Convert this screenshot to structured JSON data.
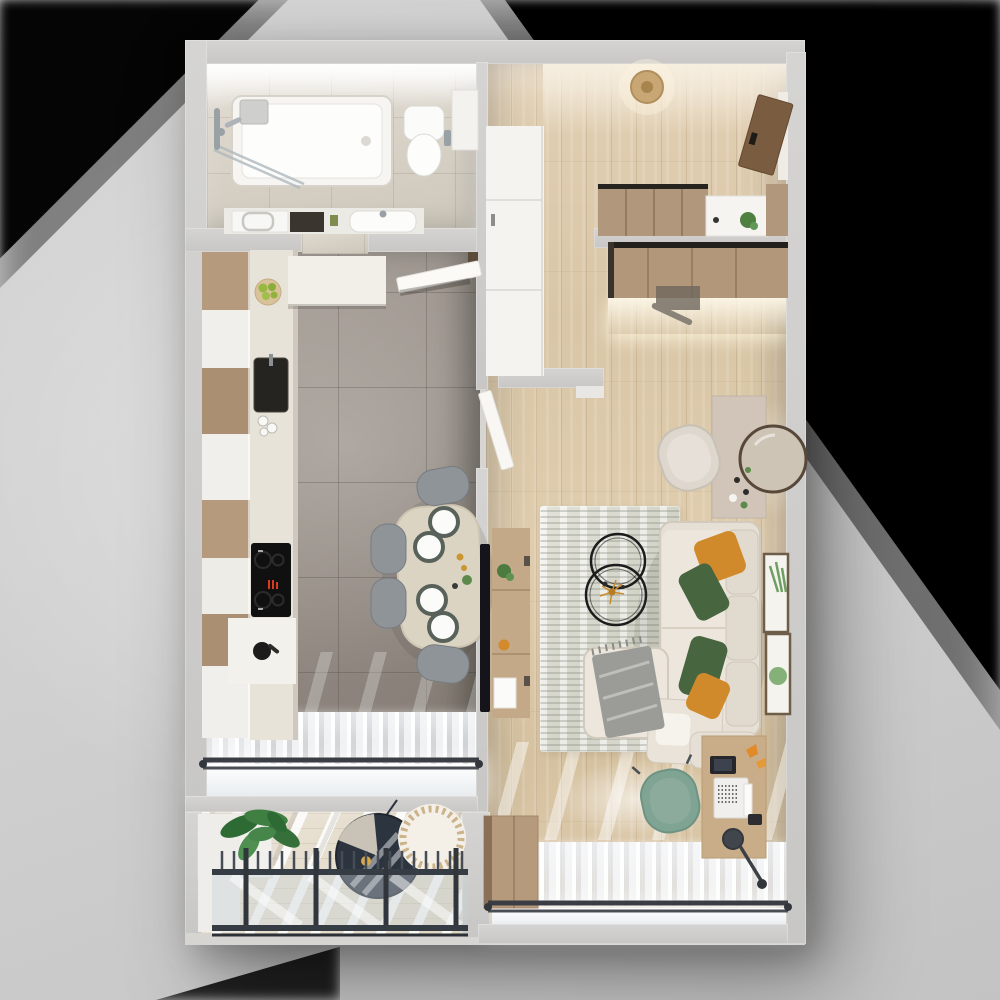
{
  "scene": {
    "description": "Top-down 3D architectural render of a one-bedroom apartment floor plan",
    "view": "top-down cutaway",
    "background": "grey studio backdrop with hard black corner shadows top-left and top-right"
  },
  "palette": {
    "bg": "#d6d6d6",
    "shadow": "#060606",
    "wall": "#d5d4d2",
    "bathFloor": "#e3ddd3",
    "kitchenTile": "#a49c94",
    "woodFloor": "#d9c6a6",
    "deck": "#ded5c2",
    "rug": "#d3d4c8",
    "counter": "#e8e3d8",
    "cabinetWood": "#b69a7e",
    "cabinetWhite": "#f1efeb",
    "sofa": "#e5dfd5",
    "pillowOrange": "#d18a2b",
    "pillowGreen": "#47653f",
    "throwGrey": "#9b9b97",
    "railing": "#363c44",
    "glassTint": "#e9edf0",
    "chairGrey": "#8f9499",
    "officeChairTeal": "#80a494",
    "doorBrown": "#7a5c40",
    "plantGreen": "#4c7a3f",
    "brass": "#c9962f",
    "displayRed": "#d93a20",
    "tvBlack": "#14141a",
    "mirrorFrame": "#57483a",
    "curtain": "#f2f3f5"
  },
  "rooms": {
    "bathroom": {
      "name": "Bathroom",
      "items": [
        "bathtub",
        "shower-glass-screen",
        "shower-set",
        "rain-shower-head",
        "toilet",
        "toilet-paper-holder",
        "storage-shelf",
        "vanity-counter",
        "washing-machine",
        "dark-cabinet",
        "washbasin"
      ]
    },
    "kitchen": {
      "name": "Kitchen",
      "items": [
        "tall-cabinet-column",
        "countertop",
        "fruit-bowl",
        "sink",
        "glasses",
        "induction-cooktop",
        "kettle",
        "white-soffit",
        "open-door",
        "dining-table",
        "dinner-plates",
        "candlesticks",
        "table-plant",
        "dining-chairs",
        "sheer-curtains",
        "curtain-rod",
        "window"
      ]
    },
    "hallway": {
      "name": "Hallway",
      "items": [
        "ceiling-light",
        "entrance-door",
        "built-in-closet",
        "wardrobe",
        "console-table",
        "console-plant"
      ]
    },
    "living_room": {
      "name": "Living room",
      "items": [
        "area-rug",
        "l-shaped-sofa",
        "back-cushions",
        "orange-pillows",
        "green-pillows",
        "grey-throw",
        "ottoman",
        "round-coffee-tables",
        "gold-decor",
        "tv",
        "tv-sideboard",
        "sideboard-plant",
        "dressing-console",
        "round-wall-mirror",
        "vanity-chair",
        "botanical-art-frames",
        "desk",
        "laptop",
        "tablet",
        "smartphone",
        "desk-lamp",
        "origami-decor",
        "office-chair",
        "tall-cabinet",
        "wardrobe-with-led-shelf",
        "open-door",
        "sheer-curtains",
        "curtain-rod",
        "window"
      ]
    },
    "balcony": {
      "name": "Balcony",
      "items": [
        "planter-bench",
        "monstera-plant",
        "wood-deck",
        "glass-railing",
        "hanging-chair",
        "wicker-pouf"
      ]
    }
  },
  "counts": {
    "dining_chairs": 4,
    "dinner_plates": 4,
    "sofa_pillows": 4,
    "art_frames": 2,
    "coffee_tables": 2,
    "windows": 2
  }
}
